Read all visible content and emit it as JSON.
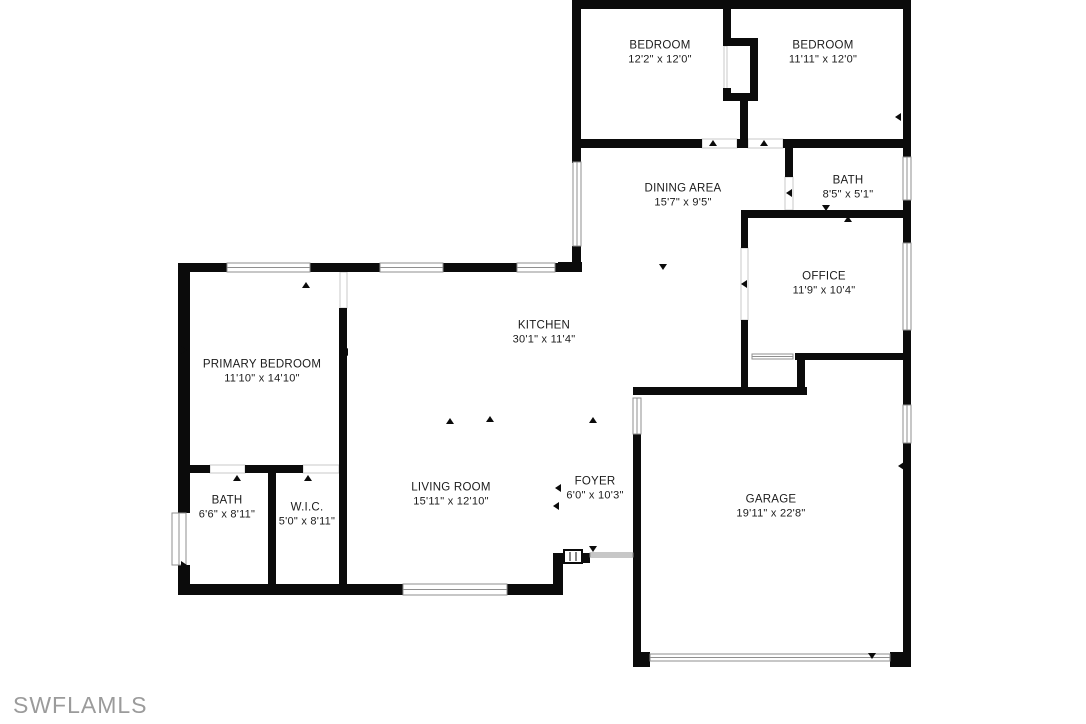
{
  "watermark": "SWFLAMLS",
  "colors": {
    "wall": "#0b0b0b",
    "text": "#1b1b1b",
    "watermark": "#9b9b9b",
    "window_stroke": "#8f8f8f",
    "background": "#ffffff"
  },
  "rooms": [
    {
      "id": "bedroom-1",
      "name": "BEDROOM",
      "dims": "12'2\" x 12'0\"",
      "cx": 660,
      "cy": 53
    },
    {
      "id": "bedroom-2",
      "name": "BEDROOM",
      "dims": "11'11\" x 12'0\"",
      "cx": 823,
      "cy": 53
    },
    {
      "id": "bath-2",
      "name": "BATH",
      "dims": "8'5\" x 5'1\"",
      "cx": 848,
      "cy": 188
    },
    {
      "id": "dining-area",
      "name": "DINING AREA",
      "dims": "15'7\" x 9'5\"",
      "cx": 683,
      "cy": 196
    },
    {
      "id": "office",
      "name": "OFFICE",
      "dims": "11'9\" x 10'4\"",
      "cx": 824,
      "cy": 284
    },
    {
      "id": "kitchen",
      "name": "KITCHEN",
      "dims": "30'1\" x 11'4\"",
      "cx": 544,
      "cy": 333
    },
    {
      "id": "primary-bedroom",
      "name": "PRIMARY BEDROOM",
      "dims": "11'10\" x 14'10\"",
      "cx": 262,
      "cy": 372
    },
    {
      "id": "living-room",
      "name": "LIVING ROOM",
      "dims": "15'11\" x 12'10\"",
      "cx": 451,
      "cy": 495
    },
    {
      "id": "foyer",
      "name": "FOYER",
      "dims": "6'0\" x 10'3\"",
      "cx": 595,
      "cy": 489
    },
    {
      "id": "garage",
      "name": "GARAGE",
      "dims": "19'11\" x 22'8\"",
      "cx": 771,
      "cy": 507
    },
    {
      "id": "bath-primary",
      "name": "BATH",
      "dims": "6'6\" x 8'11\"",
      "cx": 227,
      "cy": 508
    },
    {
      "id": "wic",
      "name": "W.I.C.",
      "dims": "5'0\" x 8'11\"",
      "cx": 307,
      "cy": 515
    }
  ],
  "walls": [
    [
      572,
      0,
      339,
      9
    ],
    [
      572,
      0,
      9,
      163
    ],
    [
      572,
      246,
      9,
      26
    ],
    [
      558,
      262,
      24,
      10
    ],
    [
      723,
      0,
      8,
      43
    ],
    [
      723,
      38,
      35,
      8
    ],
    [
      750,
      38,
      8,
      62
    ],
    [
      723,
      93,
      35,
      8
    ],
    [
      723,
      88,
      8,
      13
    ],
    [
      740,
      100,
      8,
      47
    ],
    [
      903,
      0,
      8,
      157
    ],
    [
      903,
      200,
      8,
      43
    ],
    [
      903,
      330,
      8,
      75
    ],
    [
      903,
      443,
      8,
      224
    ],
    [
      572,
      139,
      130,
      9
    ],
    [
      737,
      139,
      11,
      9
    ],
    [
      783,
      139,
      128,
      9
    ],
    [
      785,
      148,
      8,
      29
    ],
    [
      741,
      210,
      170,
      8
    ],
    [
      741,
      210,
      7,
      38
    ],
    [
      741,
      320,
      7,
      74
    ],
    [
      795,
      353,
      108,
      7
    ],
    [
      797,
      353,
      8,
      41
    ],
    [
      633,
      387,
      174,
      8
    ],
    [
      178,
      263,
      49,
      9
    ],
    [
      310,
      263,
      70,
      9
    ],
    [
      443,
      263,
      74,
      9
    ],
    [
      555,
      263,
      27,
      9
    ],
    [
      178,
      263,
      12,
      250
    ],
    [
      178,
      565,
      12,
      30
    ],
    [
      178,
      584,
      225,
      11
    ],
    [
      507,
      584,
      56,
      11
    ],
    [
      553,
      553,
      10,
      42
    ],
    [
      553,
      553,
      12,
      10
    ],
    [
      581,
      553,
      9,
      10
    ],
    [
      339,
      308,
      8,
      287
    ],
    [
      178,
      465,
      32,
      8
    ],
    [
      245,
      465,
      58,
      8
    ],
    [
      268,
      473,
      8,
      122
    ],
    [
      633,
      434,
      8,
      233
    ],
    [
      633,
      652,
      17,
      15
    ],
    [
      890,
      652,
      21,
      15
    ]
  ],
  "windows": [
    {
      "x": 227,
      "y": 263,
      "w": 83,
      "h": 9,
      "o": "h"
    },
    {
      "x": 380,
      "y": 263,
      "w": 63,
      "h": 9,
      "o": "h"
    },
    {
      "x": 517,
      "y": 263,
      "w": 38,
      "h": 9,
      "o": "h"
    },
    {
      "x": 172,
      "y": 513,
      "w": 14,
      "h": 52,
      "o": "v"
    },
    {
      "x": 573,
      "y": 162,
      "w": 8,
      "h": 84,
      "o": "v"
    },
    {
      "x": 403,
      "y": 584,
      "w": 104,
      "h": 11,
      "o": "h"
    },
    {
      "x": 903,
      "y": 157,
      "w": 8,
      "h": 43,
      "o": "v"
    },
    {
      "x": 903,
      "y": 243,
      "w": 8,
      "h": 87,
      "o": "v"
    },
    {
      "x": 903,
      "y": 405,
      "w": 8,
      "h": 38,
      "o": "v"
    },
    {
      "x": 633,
      "y": 398,
      "w": 8,
      "h": 36,
      "o": "v"
    },
    {
      "x": 650,
      "y": 654,
      "w": 240,
      "h": 7,
      "o": "h"
    },
    {
      "x": 752,
      "y": 354,
      "w": 41,
      "h": 5,
      "o": "h"
    },
    {
      "x": 590,
      "y": 553,
      "w": 43,
      "h": 4,
      "o": "h"
    }
  ],
  "openings": [
    {
      "x": 702,
      "y": 139,
      "w": 35,
      "h": 9,
      "o": "h"
    },
    {
      "x": 748,
      "y": 139,
      "w": 35,
      "h": 9,
      "o": "h"
    },
    {
      "x": 785,
      "y": 177,
      "w": 8,
      "h": 33,
      "o": "v"
    },
    {
      "x": 741,
      "y": 248,
      "w": 7,
      "h": 72,
      "o": "v"
    },
    {
      "x": 340,
      "y": 272,
      "w": 7,
      "h": 36,
      "o": "v"
    },
    {
      "x": 210,
      "y": 465,
      "w": 35,
      "h": 8,
      "o": "h"
    },
    {
      "x": 303,
      "y": 465,
      "w": 36,
      "h": 8,
      "o": "h"
    },
    {
      "x": 724,
      "y": 46,
      "w": 3,
      "h": 47,
      "o": "v"
    }
  ],
  "door_symbol": {
    "x": 564,
    "y": 550,
    "w": 18,
    "h": 13
  },
  "markers": [
    {
      "x": 713,
      "y": 143,
      "d": "up"
    },
    {
      "x": 764,
      "y": 143,
      "d": "up"
    },
    {
      "x": 789,
      "y": 193,
      "d": "left"
    },
    {
      "x": 826,
      "y": 208,
      "d": "down"
    },
    {
      "x": 848,
      "y": 219,
      "d": "up"
    },
    {
      "x": 744,
      "y": 284,
      "d": "left"
    },
    {
      "x": 663,
      "y": 267,
      "d": "down"
    },
    {
      "x": 306,
      "y": 285,
      "d": "up"
    },
    {
      "x": 577,
      "y": 118,
      "d": "right"
    },
    {
      "x": 898,
      "y": 117,
      "d": "left"
    },
    {
      "x": 184,
      "y": 350,
      "d": "right"
    },
    {
      "x": 450,
      "y": 421,
      "d": "up"
    },
    {
      "x": 490,
      "y": 419,
      "d": "up"
    },
    {
      "x": 593,
      "y": 420,
      "d": "up"
    },
    {
      "x": 558,
      "y": 488,
      "d": "left"
    },
    {
      "x": 556,
      "y": 506,
      "d": "left"
    },
    {
      "x": 593,
      "y": 549,
      "d": "down"
    },
    {
      "x": 237,
      "y": 478,
      "d": "up"
    },
    {
      "x": 308,
      "y": 478,
      "d": "up"
    },
    {
      "x": 345,
      "y": 352,
      "d": "left"
    },
    {
      "x": 184,
      "y": 565,
      "d": "right"
    },
    {
      "x": 872,
      "y": 656,
      "d": "down"
    },
    {
      "x": 901,
      "y": 466,
      "d": "left"
    }
  ]
}
